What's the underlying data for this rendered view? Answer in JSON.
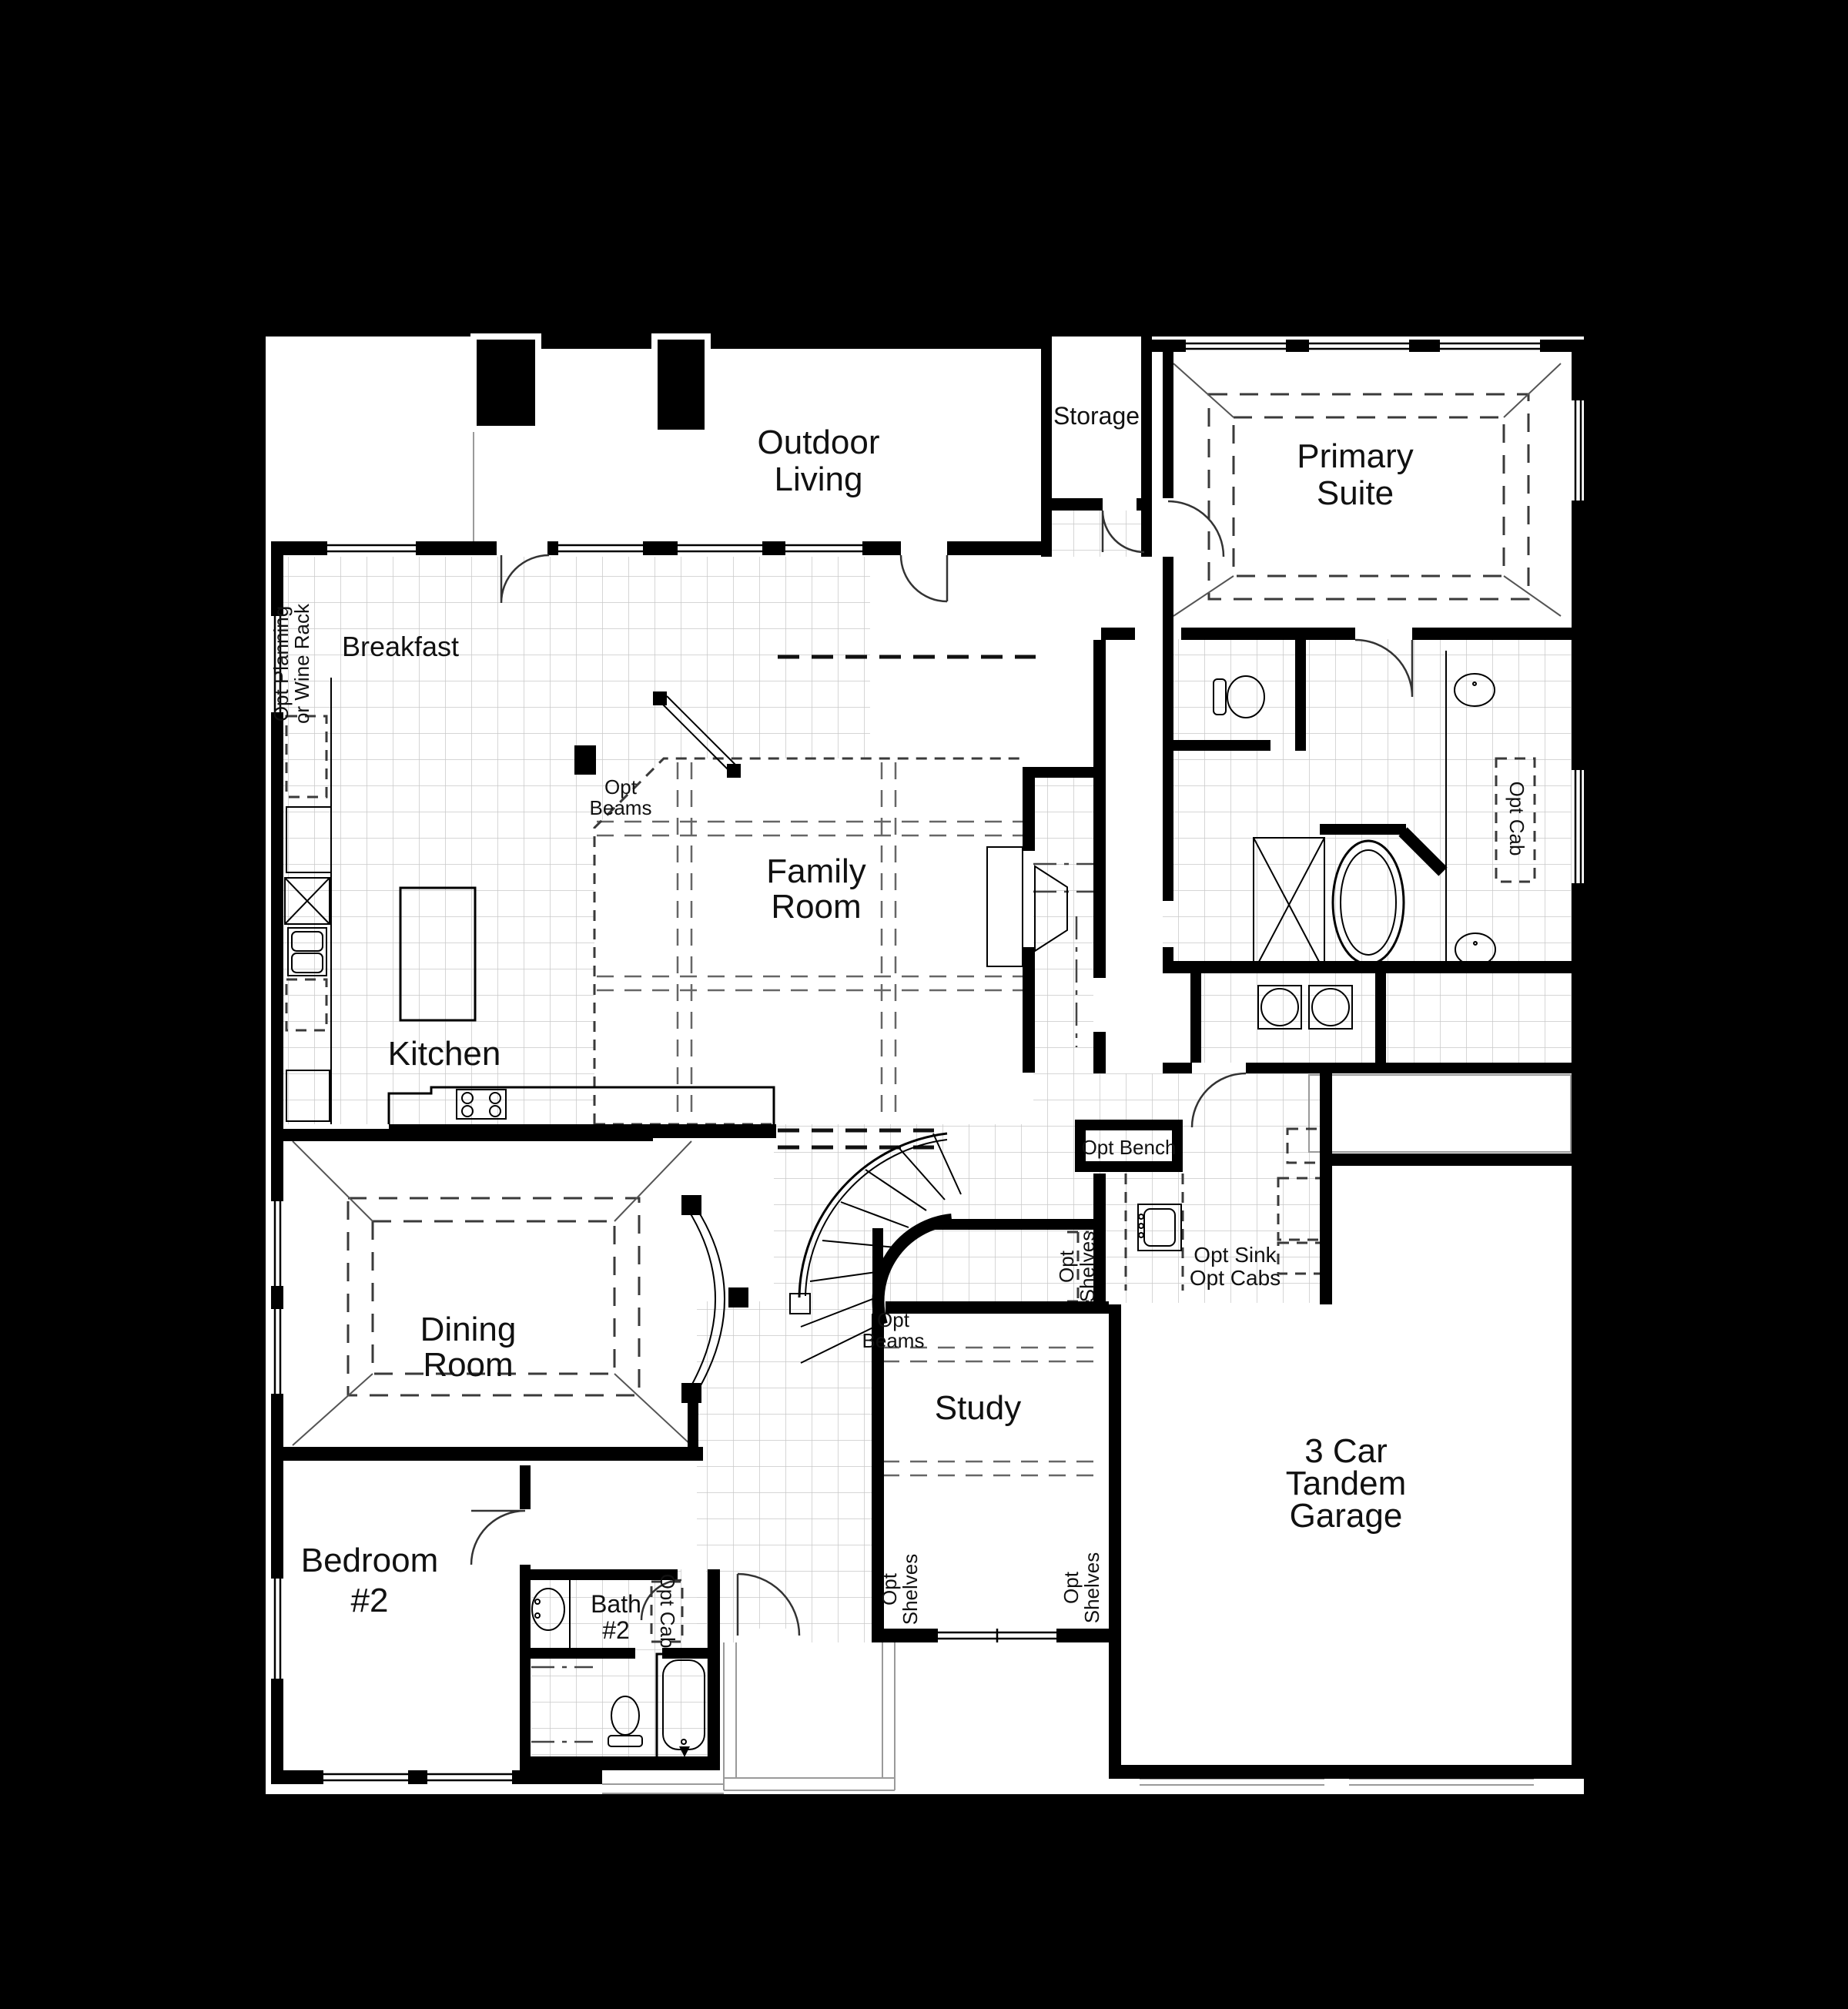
{
  "meta": {
    "background_color": "#000000",
    "plan_color": "#ffffff",
    "wall_color": "#000000",
    "tile_line_color": "#c9c9c9"
  },
  "rooms": {
    "outdoor_living": {
      "line1": "Outdoor",
      "line2": "Living"
    },
    "storage": {
      "label": "Storage"
    },
    "primary_suite": {
      "line1": "Primary",
      "line2": "Suite"
    },
    "breakfast": {
      "label": "Breakfast"
    },
    "family_room": {
      "line1": "Family",
      "line2": "Room"
    },
    "kitchen": {
      "label": "Kitchen"
    },
    "dining_room": {
      "line1": "Dining",
      "line2": "Room"
    },
    "study": {
      "label": "Study"
    },
    "garage": {
      "line1": "3 Car",
      "line2": "Tandem",
      "line3": "Garage"
    },
    "bedroom2": {
      "line1": "Bedroom",
      "line2": "#2"
    },
    "bath2": {
      "line1": "Bath",
      "line2": "#2"
    }
  },
  "options": {
    "opt_planning": {
      "line1": "Opt Planning",
      "line2": "or Wine Rack"
    },
    "opt_beams_family": {
      "line1": "Opt",
      "line2": "Beams"
    },
    "opt_beams_study": {
      "line1": "Opt",
      "line2": "Beams"
    },
    "opt_bench": {
      "label": "Opt Bench"
    },
    "opt_shelves_mud": {
      "line1": "Opt",
      "line2": "Shelves"
    },
    "opt_sink_cabs": {
      "line1": "Opt Sink",
      "line2": "Opt Cabs"
    },
    "opt_cab_primary": {
      "label": "Opt Cab"
    },
    "opt_cab_bath2": {
      "label": "Opt Cab"
    },
    "opt_shelves_study_left": {
      "line1": "Opt",
      "line2": "Shelves"
    },
    "opt_shelves_study_right": {
      "line1": "Opt",
      "line2": "Shelves"
    }
  }
}
